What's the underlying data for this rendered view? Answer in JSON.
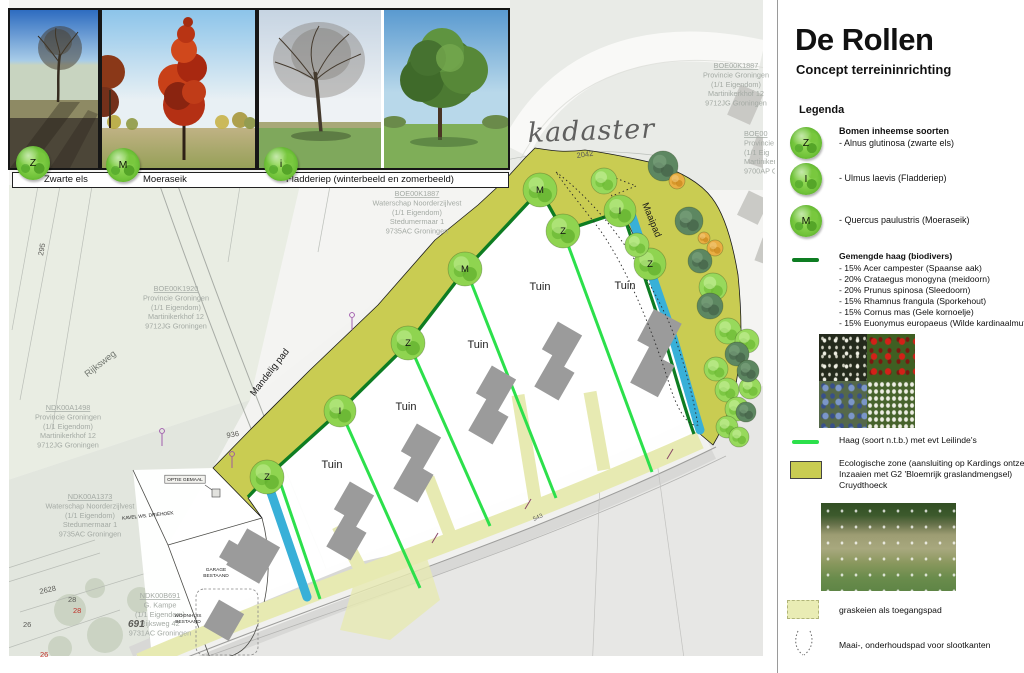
{
  "title": "De Rollen",
  "subtitle": "Concept terreininrichting",
  "photo_strip": {
    "captions": [
      "Zwarte els",
      "Moeraseik",
      "Fladderiep (winterbeeld  en zomerbeeld)"
    ],
    "icons": [
      "Z",
      "M",
      "i"
    ]
  },
  "legend": {
    "heading": "Legenda",
    "trees_heading": "Bomen inheemse soorten",
    "tree_items": [
      {
        "icon": "Z",
        "label": "- Alnus glutinosa (zwarte els)"
      },
      {
        "icon": "I",
        "label": "- Ulmus laevis (Fladderiep)"
      },
      {
        "icon": "M",
        "label": "- Quercus paulustris (Moeraseik)"
      }
    ],
    "mixed_hedge_heading": "Gemengde haag (biodivers)",
    "mixed_hedge_items": [
      "- 15% Acer campester (Spaanse aak)",
      "- 20% Crataegus monogyna (meidoorn)",
      "- 20% Prunus spinosa (Sleedoorn)",
      "- 15% Rhamnus frangula (Sporkehout)",
      "- 15% Cornus mas (Gele kornoelje)",
      "- 15% Euonymus europaeus (Wilde kardinaalmuts)"
    ],
    "hedge_ntb_label": "Haag (soort n.t.b.) met evt Leilinde's",
    "eco_zone_lines": [
      "Ecologische zone (aansluiting op Kardings ontzet)",
      "Inzaaien met G2 'Bloemrijk graslandmengsel)",
      "Cruydthoeck"
    ],
    "graskeien_label": "graskeien als toegangspad",
    "maaipad_label": "Maai-, onderhoudspad voor slootkanten"
  },
  "map": {
    "watermark": "kadaster",
    "road_label": "Rijksweg",
    "tuin_text": "Tuin",
    "path_labels": [
      {
        "text": "Mandelig pad",
        "x": 272,
        "y": 374,
        "rot": -52
      },
      {
        "text": "Maaipad",
        "x": 649,
        "y": 221,
        "rot": 68
      }
    ],
    "tuin_labels": [
      {
        "x": 332,
        "y": 468
      },
      {
        "x": 406,
        "y": 410
      },
      {
        "x": 478,
        "y": 348
      },
      {
        "x": 540,
        "y": 290
      },
      {
        "x": 625,
        "y": 289
      }
    ],
    "owner_blocks": [
      {
        "x": 736,
        "y": 68,
        "anchor": "middle",
        "lines": [
          "BOE00K1887",
          "Provincie Groningen",
          "(1/1 Eigendom)",
          "Martinikerkhof 12",
          "9712JG Groningen"
        ]
      },
      {
        "x": 744,
        "y": 136,
        "anchor": "start",
        "lines": [
          "BOE00",
          "Provincie",
          "(1/1 Eig",
          "Martinikerkhof",
          "9700AP G"
        ]
      },
      {
        "x": 417,
        "y": 196,
        "anchor": "middle",
        "lines": [
          "BOE00K1887",
          "Waterschap Noorderzijlvest",
          "(1/1 Eigendom)",
          "Stedumermaar 1",
          "9735AC Groningen"
        ]
      },
      {
        "x": 176,
        "y": 291,
        "anchor": "middle",
        "lines": [
          "BOE00K1920",
          "Provincie Groningen",
          "(1/1 Eigendom)",
          "Martinikerkhof 12",
          "9712JG Groningen"
        ]
      },
      {
        "x": 68,
        "y": 410,
        "anchor": "middle",
        "lines": [
          "NDK00A1498",
          "Provincie Groningen",
          "(1/1 Eigendom)",
          "Martinikerkhof 12",
          "9712JG Groningen"
        ]
      },
      {
        "x": 90,
        "y": 499,
        "anchor": "middle",
        "lines": [
          "NDK00A1373",
          "Waterschap Noorderzijlvest",
          "(1/1 Eigendom)",
          "Stedumermaar 1",
          "9735AC Groningen"
        ]
      },
      {
        "x": 160,
        "y": 598,
        "anchor": "middle",
        "lines": [
          "NDK00B691",
          "G. Kampe",
          "(1/1 Eigendom)",
          "Rijksweg 42",
          "9731AC Groningen"
        ]
      }
    ],
    "parcel_numbers": [
      {
        "text": "295",
        "x": 43,
        "y": 256,
        "rot": -80
      },
      {
        "text": "2042",
        "x": 577,
        "y": 158,
        "rot": -8
      },
      {
        "text": "936",
        "x": 227,
        "y": 438,
        "rot": -10
      },
      {
        "text": "2628",
        "x": 40,
        "y": 594,
        "rot": -12
      },
      {
        "text": "28",
        "x": 68,
        "y": 602
      },
      {
        "text": "28",
        "x": 73,
        "y": 613,
        "color": "#c03028"
      },
      {
        "text": "26",
        "x": 23,
        "y": 627
      },
      {
        "text": "26",
        "x": 40,
        "y": 657,
        "color": "#c03028"
      },
      {
        "text": "691",
        "x": 128,
        "y": 627,
        "bold": true,
        "italic": true,
        "size": 10
      },
      {
        "text": "543",
        "x": 534,
        "y": 521,
        "rot": -24,
        "size": 6
      }
    ],
    "small_labels": [
      {
        "text": "OPTIE GEMAAL",
        "x": 185,
        "y": 481,
        "boxed": true
      },
      {
        "text": "KAVEL WS. DRIEHOEK",
        "x": 148,
        "y": 517,
        "rot": -6
      },
      {
        "text": "GARAGE",
        "x": 216,
        "y": 571
      },
      {
        "text": "BESTAAND",
        "x": 216,
        "y": 577
      },
      {
        "text": "WOONHUIS",
        "x": 188,
        "y": 617
      },
      {
        "text": "BESTAAND",
        "x": 188,
        "y": 623
      }
    ],
    "trees": [
      {
        "x": 267,
        "y": 477,
        "r": 17,
        "kind": "species",
        "letter": "Z"
      },
      {
        "x": 340,
        "y": 411,
        "r": 16,
        "kind": "species",
        "letter": "I"
      },
      {
        "x": 408,
        "y": 343,
        "r": 17,
        "kind": "species",
        "letter": "Z"
      },
      {
        "x": 465,
        "y": 269,
        "r": 17,
        "kind": "species",
        "letter": "M"
      },
      {
        "x": 540,
        "y": 190,
        "r": 17,
        "kind": "species",
        "letter": "M"
      },
      {
        "x": 563,
        "y": 231,
        "r": 17,
        "kind": "species",
        "letter": "Z"
      },
      {
        "x": 620,
        "y": 211,
        "r": 16,
        "kind": "species",
        "letter": "I"
      },
      {
        "x": 650,
        "y": 264,
        "r": 16,
        "kind": "species",
        "letter": "Z"
      },
      {
        "x": 604,
        "y": 181,
        "r": 13,
        "kind": "light"
      },
      {
        "x": 637,
        "y": 245,
        "r": 12,
        "kind": "light"
      },
      {
        "x": 713,
        "y": 287,
        "r": 14,
        "kind": "light"
      },
      {
        "x": 728,
        "y": 331,
        "r": 13,
        "kind": "light"
      },
      {
        "x": 747,
        "y": 341,
        "r": 12,
        "kind": "light"
      },
      {
        "x": 716,
        "y": 369,
        "r": 12,
        "kind": "light"
      },
      {
        "x": 727,
        "y": 390,
        "r": 12,
        "kind": "light"
      },
      {
        "x": 750,
        "y": 388,
        "r": 11,
        "kind": "light"
      },
      {
        "x": 737,
        "y": 409,
        "r": 12,
        "kind": "light"
      },
      {
        "x": 727,
        "y": 427,
        "r": 11,
        "kind": "light"
      },
      {
        "x": 739,
        "y": 437,
        "r": 10,
        "kind": "light"
      },
      {
        "x": 663,
        "y": 166,
        "r": 15,
        "kind": "dark"
      },
      {
        "x": 689,
        "y": 221,
        "r": 14,
        "kind": "dark"
      },
      {
        "x": 700,
        "y": 261,
        "r": 12,
        "kind": "dark"
      },
      {
        "x": 710,
        "y": 306,
        "r": 13,
        "kind": "dark"
      },
      {
        "x": 737,
        "y": 354,
        "r": 12,
        "kind": "dark"
      },
      {
        "x": 748,
        "y": 371,
        "r": 11,
        "kind": "dark"
      },
      {
        "x": 746,
        "y": 412,
        "r": 10,
        "kind": "dark"
      },
      {
        "x": 677,
        "y": 181,
        "r": 8,
        "kind": "orange"
      },
      {
        "x": 715,
        "y": 248,
        "r": 8,
        "kind": "orange"
      },
      {
        "x": 704,
        "y": 238,
        "r": 6,
        "kind": "orange"
      }
    ],
    "colors": {
      "eco_zone": "#c9cc52",
      "graskeien_path": "#e7eab2",
      "mixed_hedge": "#0e7d22",
      "ntb_hedge": "#2ce04b",
      "water": "#38b0d8",
      "tree_green": "#8fd450",
      "building_gray": "#9b9b9b"
    }
  }
}
